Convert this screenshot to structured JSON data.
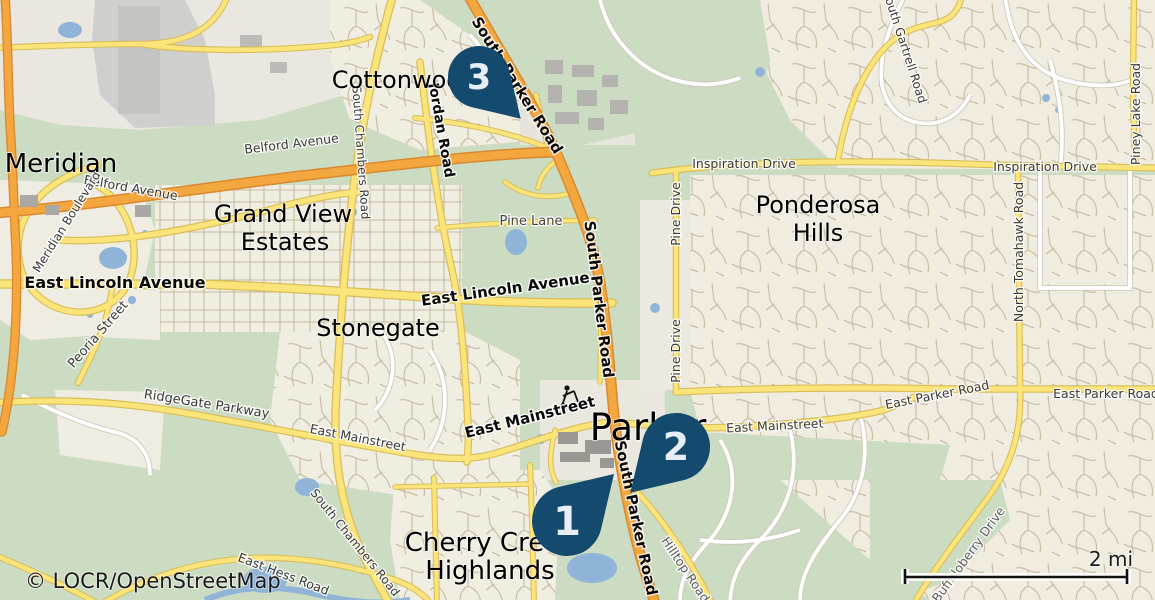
{
  "map": {
    "attribution": "© LOCR/OpenStreetMap",
    "scale": {
      "label": "2 mi"
    },
    "markers": [
      {
        "number": "1"
      },
      {
        "number": "2"
      },
      {
        "number": "3"
      }
    ],
    "colors": {
      "marker": "#134a6e",
      "marker_number": "#e7eef5",
      "land_open": "#ccdcc3",
      "land_residential": "#f0ede1",
      "land_industrial": "#cfcfcd",
      "highway_orange": "#f4a73f",
      "road_yellow": "#fbe47a",
      "road_white": "#ffffff",
      "water": "#8fb4d8"
    },
    "places": [
      "Meridian",
      "Cottonwood",
      "Grand View",
      "Estates",
      "Stonegate",
      "Ponderosa",
      "Hills",
      "Parker",
      "Cherry Creek",
      "Highlands"
    ],
    "road_labels": [
      "South Parker Road",
      "South Parker Road",
      "South Parker Road",
      "Jordan Road",
      "South Chambers Road",
      "South Chambers Road",
      "Belford Avenue",
      "Belford Avenue",
      "East Lincoln Avenue",
      "East Lincoln Avenue",
      "Pine Lane",
      "Inspiration Drive",
      "Inspiration Drive",
      "Pine Drive",
      "Pine Drive",
      "South Gartrell Road",
      "Piney Lake Road",
      "North Tomahawk Road",
      "East Parker Road",
      "East Parker Road",
      "RidgeGate Parkway",
      "East Mainstreet",
      "East Mainstreet",
      "East Mainstreet",
      "East Hess Road",
      "Hilltop Road",
      "Buffaloberry Drive",
      "Peoria Street",
      "Meridian Boulevard"
    ]
  }
}
